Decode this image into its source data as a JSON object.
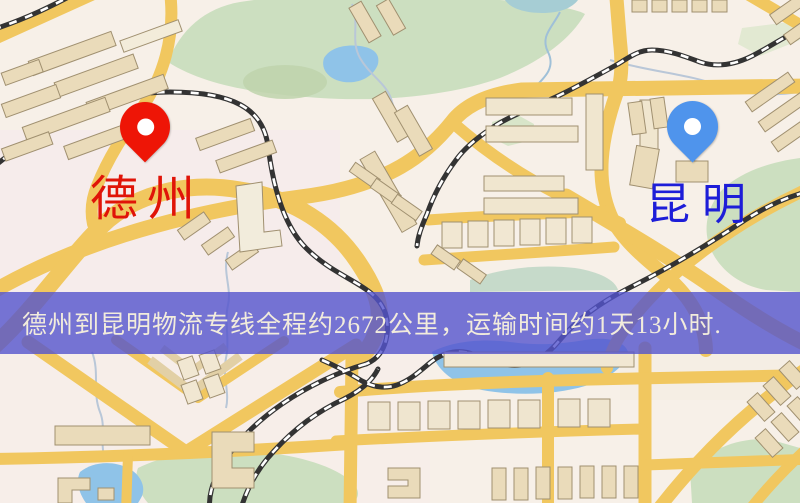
{
  "map_image": {
    "origin_marker": {
      "label": "德州",
      "pin_color": "#ee1506",
      "label_color": "#e01408"
    },
    "destination_marker": {
      "label": "昆明",
      "pin_color": "#4f94ec",
      "label_color": "#1d1dd8"
    },
    "info_banner": {
      "text": "德州到昆明物流专线全程约2672公里，运输时间约1天13小时.",
      "distance_km": "2672",
      "duration": "1天13小时",
      "background_color": "#5454cd",
      "text_color": "#f2ecdc"
    },
    "map_style_colors": {
      "road": "#f1c75f",
      "park": "#ccdfc0",
      "water": "#8fc3e8",
      "building": "#eadbba",
      "railway": "#333333"
    }
  }
}
